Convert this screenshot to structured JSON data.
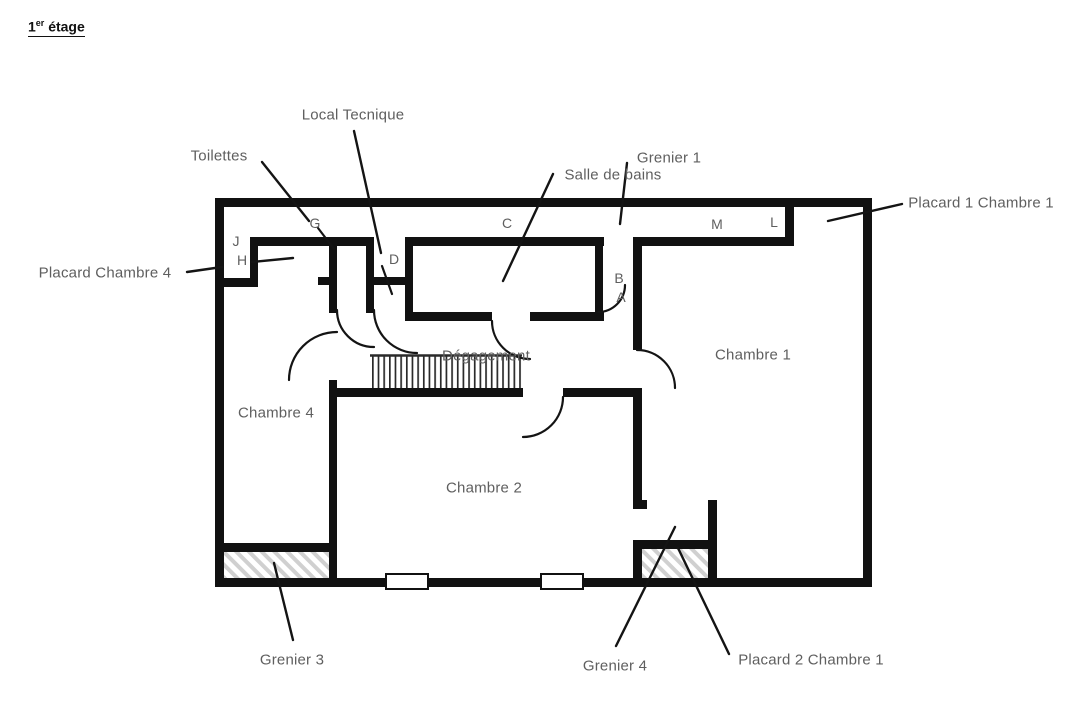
{
  "title": {
    "base": "1",
    "superscript": "er",
    "suffix": " étage"
  },
  "floorplan": {
    "room_labels": {
      "toilettes": "Toilettes",
      "local_technique": "Local Tecnique",
      "salle_de_bains": "Salle de bains",
      "grenier1": "Grenier 1",
      "placard1_chambre1": "Placard 1 Chambre 1",
      "placard_chambre4": "Placard Chambre 4",
      "chambre1": "Chambre 1",
      "chambre2": "Chambre 2",
      "chambre4": "Chambre 4",
      "degagement": "Dégagement",
      "grenier3": "Grenier 3",
      "grenier4": "Grenier 4",
      "placard2_chambre1": "Placard 2 Chambre 1"
    },
    "door_letters": {
      "a": "A",
      "b": "B",
      "c": "C",
      "d": "D",
      "g": "G",
      "h": "H",
      "j": "J",
      "l": "L",
      "m": "M"
    },
    "colors": {
      "wall": "#111111",
      "label": "#5f5f5f",
      "hatch": "#d0d0d0",
      "background": "#ffffff"
    }
  }
}
